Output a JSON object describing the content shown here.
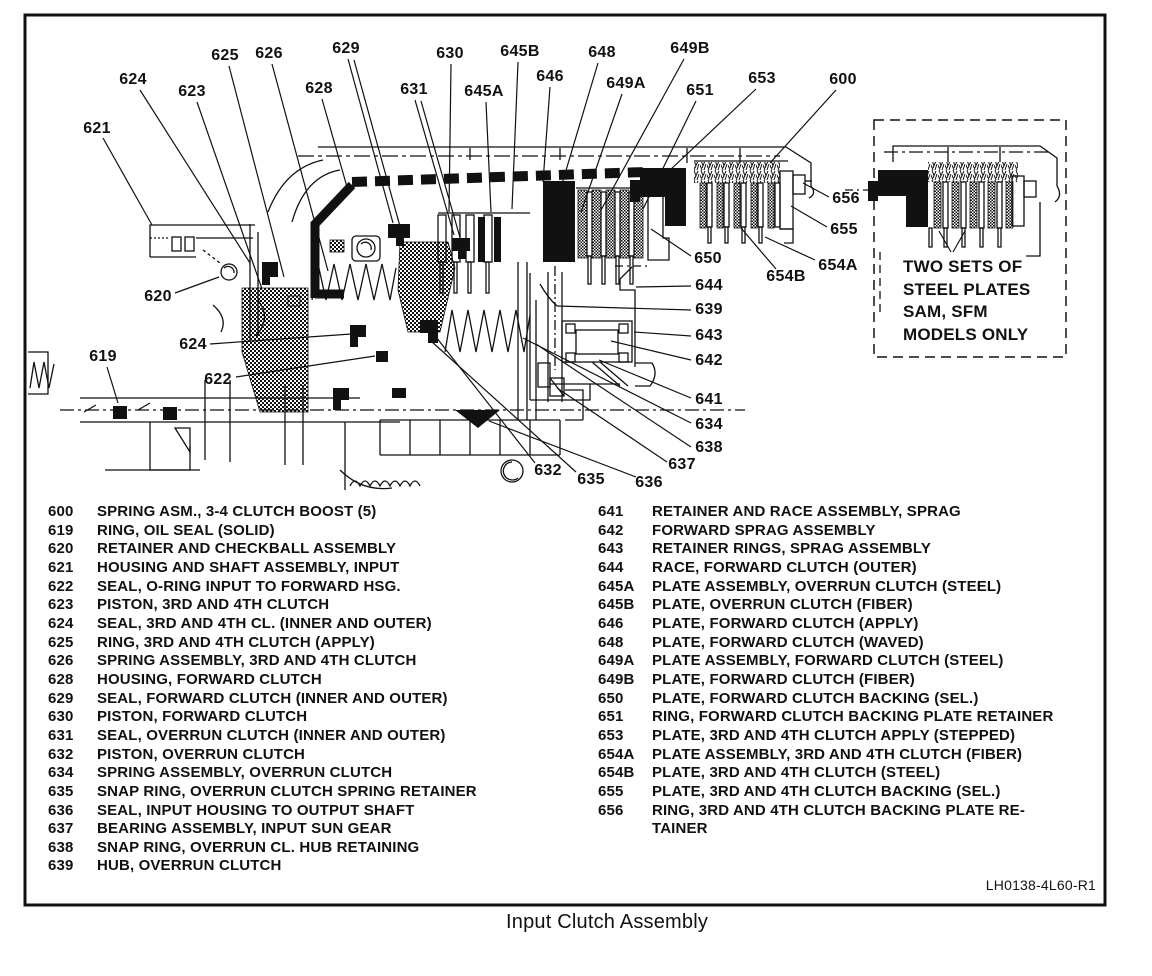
{
  "figure": {
    "caption": "Input Clutch Assembly",
    "reference": "LH0138-4L60-R1",
    "inset_note_lines": [
      "TWO SETS OF",
      "STEEL PLATES",
      "SAM, SFM",
      "MODELS ONLY"
    ]
  },
  "callouts": [
    "621",
    "624",
    "623",
    "625",
    "626",
    "628",
    "629",
    "631",
    "630",
    "645A",
    "645B",
    "646",
    "648",
    "649A",
    "649B",
    "651",
    "653",
    "600",
    "656",
    "655",
    "654A",
    "654B",
    "650",
    "644",
    "639",
    "643",
    "642",
    "641",
    "634",
    "638",
    "637",
    "636",
    "635",
    "632",
    "620",
    "624",
    "622",
    "619"
  ],
  "parts_list": {
    "columns": [
      {
        "items": [
          {
            "num": "600",
            "desc": "SPRING ASM., 3-4 CLUTCH BOOST (5)"
          },
          {
            "num": "619",
            "desc": "RING, OIL SEAL (SOLID)"
          },
          {
            "num": "620",
            "desc": "RETAINER AND CHECKBALL ASSEMBLY"
          },
          {
            "num": "621",
            "desc": "HOUSING AND SHAFT ASSEMBLY, INPUT"
          },
          {
            "num": "622",
            "desc": "SEAL, O-RING INPUT TO FORWARD HSG."
          },
          {
            "num": "623",
            "desc": "PISTON, 3RD AND 4TH CLUTCH"
          },
          {
            "num": "624",
            "desc": "SEAL, 3RD AND 4TH CL. (INNER AND OUTER)"
          },
          {
            "num": "625",
            "desc": "RING, 3RD AND 4TH CLUTCH (APPLY)"
          },
          {
            "num": "626",
            "desc": "SPRING ASSEMBLY, 3RD AND 4TH CLUTCH"
          },
          {
            "num": "628",
            "desc": "HOUSING, FORWARD CLUTCH"
          },
          {
            "num": "629",
            "desc": "SEAL, FORWARD CLUTCH (INNER AND OUTER)"
          },
          {
            "num": "630",
            "desc": "PISTON, FORWARD CLUTCH"
          },
          {
            "num": "631",
            "desc": "SEAL, OVERRUN CLUTCH (INNER AND OUTER)"
          },
          {
            "num": "632",
            "desc": "PISTON, OVERRUN CLUTCH"
          },
          {
            "num": "634",
            "desc": "SPRING ASSEMBLY, OVERRUN CLUTCH"
          },
          {
            "num": "635",
            "desc": "SNAP RING, OVERRUN CLUTCH SPRING RETAINER"
          },
          {
            "num": "636",
            "desc": "SEAL, INPUT HOUSING TO OUTPUT SHAFT"
          },
          {
            "num": "637",
            "desc": "BEARING ASSEMBLY, INPUT SUN GEAR"
          },
          {
            "num": "638",
            "desc": "SNAP RING, OVERRUN CL. HUB RETAINING"
          },
          {
            "num": "639",
            "desc": "HUB, OVERRUN CLUTCH"
          }
        ]
      },
      {
        "items": [
          {
            "num": "641",
            "desc": "RETAINER AND RACE ASSEMBLY, SPRAG"
          },
          {
            "num": "642",
            "desc": "FORWARD SPRAG ASSEMBLY"
          },
          {
            "num": "643",
            "desc": "RETAINER RINGS, SPRAG ASSEMBLY"
          },
          {
            "num": "644",
            "desc": "RACE, FORWARD CLUTCH (OUTER)"
          },
          {
            "num": "645A",
            "desc": "PLATE ASSEMBLY, OVERRUN CLUTCH (STEEL)"
          },
          {
            "num": "645B",
            "desc": "PLATE, OVERRUN CLUTCH (FIBER)"
          },
          {
            "num": "646",
            "desc": "PLATE, FORWARD CLUTCH (APPLY)"
          },
          {
            "num": "648",
            "desc": "PLATE, FORWARD CLUTCH (WAVED)"
          },
          {
            "num": "649A",
            "desc": "PLATE ASSEMBLY, FORWARD CLUTCH (STEEL)"
          },
          {
            "num": "649B",
            "desc": "PLATE, FORWARD CLUTCH (FIBER)"
          },
          {
            "num": "650",
            "desc": "PLATE, FORWARD CLUTCH BACKING (SEL.)"
          },
          {
            "num": "651",
            "desc": "RING, FORWARD CLUTCH BACKING PLATE RETAINER"
          },
          {
            "num": "653",
            "desc": "PLATE, 3RD AND 4TH CLUTCH APPLY (STEPPED)"
          },
          {
            "num": "654A",
            "desc": "PLATE ASSEMBLY, 3RD AND 4TH CLUTCH (FIBER)"
          },
          {
            "num": "654B",
            "desc": "PLATE, 3RD AND 4TH CLUTCH (STEEL)"
          },
          {
            "num": "655",
            "desc": "PLATE, 3RD AND 4TH CLUTCH BACKING (SEL.)"
          },
          {
            "num": "656",
            "desc": "RING, 3RD AND 4TH CLUTCH BACKING PLATE RE-\nTAINER"
          }
        ]
      }
    ]
  }
}
